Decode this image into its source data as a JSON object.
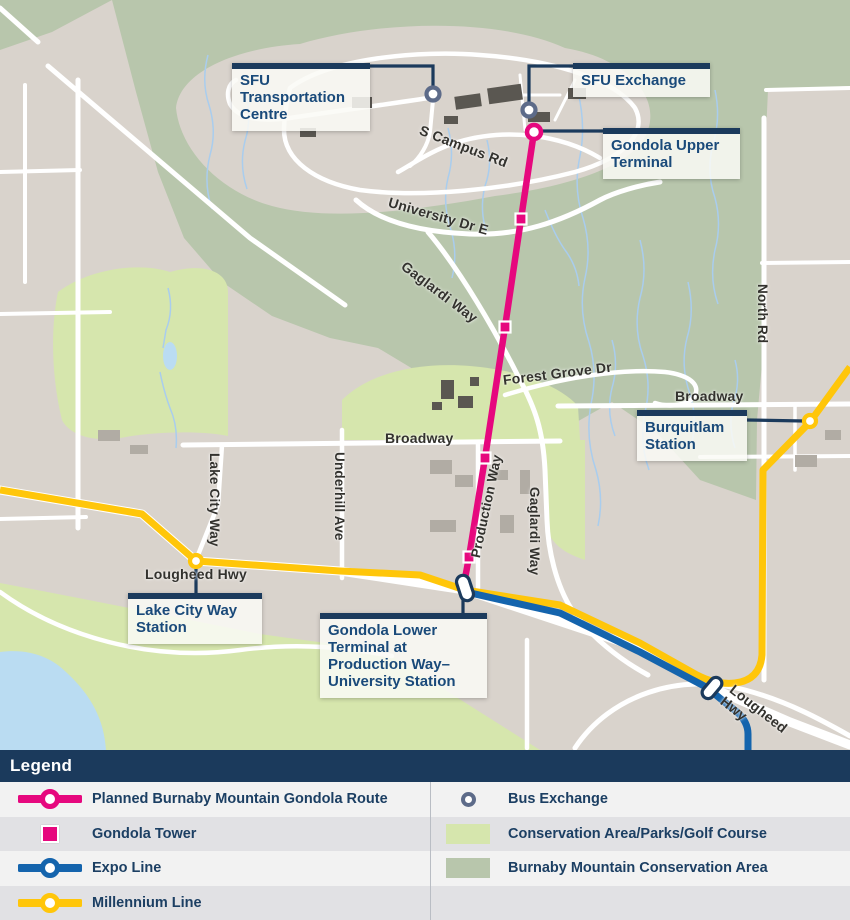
{
  "map": {
    "callouts": {
      "sfu_transportation_centre": "SFU Transportation Centre",
      "sfu_exchange": "SFU Exchange",
      "gondola_upper_terminal": "Gondola Upper Terminal",
      "burquitlam_station": "Burquitlam Station",
      "lake_city_way_station": "Lake City Way Station",
      "gondola_lower_terminal": "Gondola Lower Terminal at Production Way–University Station"
    },
    "road_labels": {
      "s_campus_rd": "S Campus Rd",
      "university_dr_e": "University Dr E",
      "gaglardi_way_upper": "Gaglardi Way",
      "forest_grove_dr": "Forest Grove Dr",
      "broadway_west": "Broadway",
      "broadway_east": "Broadway",
      "north_rd": "North Rd",
      "lake_city_way": "Lake City Way",
      "underhill_ave": "Underhill Ave",
      "production_way": "Production Way",
      "gaglardi_way_lower": "Gaglardi Way",
      "lougheed_hwy_west": "Lougheed Hwy",
      "lougheed_hwy_east": "Lougheed Hwy"
    },
    "colors": {
      "gondola_pink": "#e6087e",
      "expo_blue": "#1464ad",
      "millennium_yellow": "#ffc60a",
      "callout_navy": "#1b3a5c",
      "bus_exchange_slate": "#5d6b89",
      "parks_green": "#d6e6ad",
      "conservation_green": "#b8c6ac",
      "water_blue": "#badcf2",
      "base_tan": "#d9d3cc",
      "road_white": "#ffffff"
    }
  },
  "legend": {
    "title": "Legend",
    "items_left": [
      {
        "icon": "gondola-route-line",
        "label": "Planned Burnaby Mountain Gondola Route"
      },
      {
        "icon": "gondola-tower",
        "label": "Gondola Tower"
      },
      {
        "icon": "expo-line",
        "label": "Expo Line"
      },
      {
        "icon": "millennium-line",
        "label": "Millennium Line"
      }
    ],
    "items_right": [
      {
        "icon": "bus-exchange",
        "label": "Bus Exchange"
      },
      {
        "icon": "parks-swatch",
        "label": "Conservation Area/Parks/Golf Course"
      },
      {
        "icon": "conservation-swatch",
        "label": "Burnaby Mountain Conservation Area"
      }
    ]
  }
}
